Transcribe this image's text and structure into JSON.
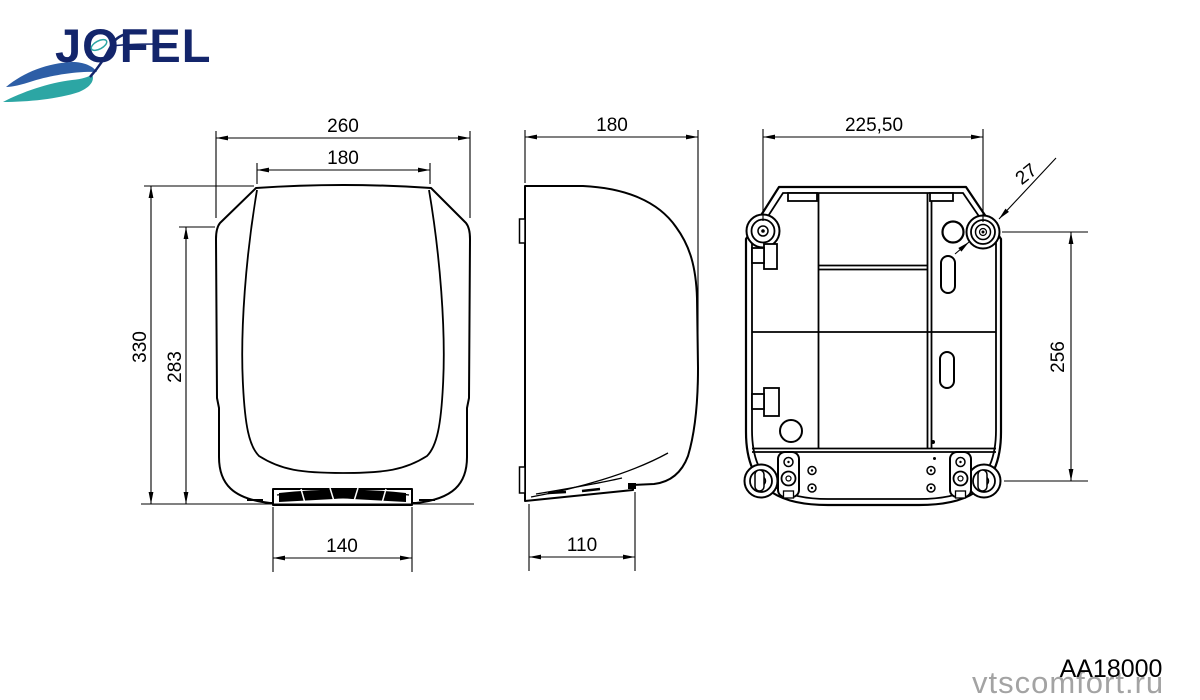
{
  "logo": {
    "brand": "JOFEL"
  },
  "colors": {
    "line": "#000000",
    "logo_navy": "#13256b",
    "logo_blue": "#2d5ea6",
    "logo_teal": "#2ca6a4",
    "watermark_gray": "#a3a3a3"
  },
  "dims": {
    "front_overall_width": "260",
    "front_top_width": "180",
    "front_overall_height": "330",
    "front_body_height": "283",
    "front_outlet_width": "140",
    "side_depth": "180",
    "side_outlet_depth": "110",
    "rear_hole_spacing_horizontal": "225,50",
    "rear_hole_diameter": "27",
    "rear_hole_spacing_vertical": "256"
  },
  "footer": {
    "model_code": "AA18000",
    "watermark": "vtscomfort.ru"
  }
}
